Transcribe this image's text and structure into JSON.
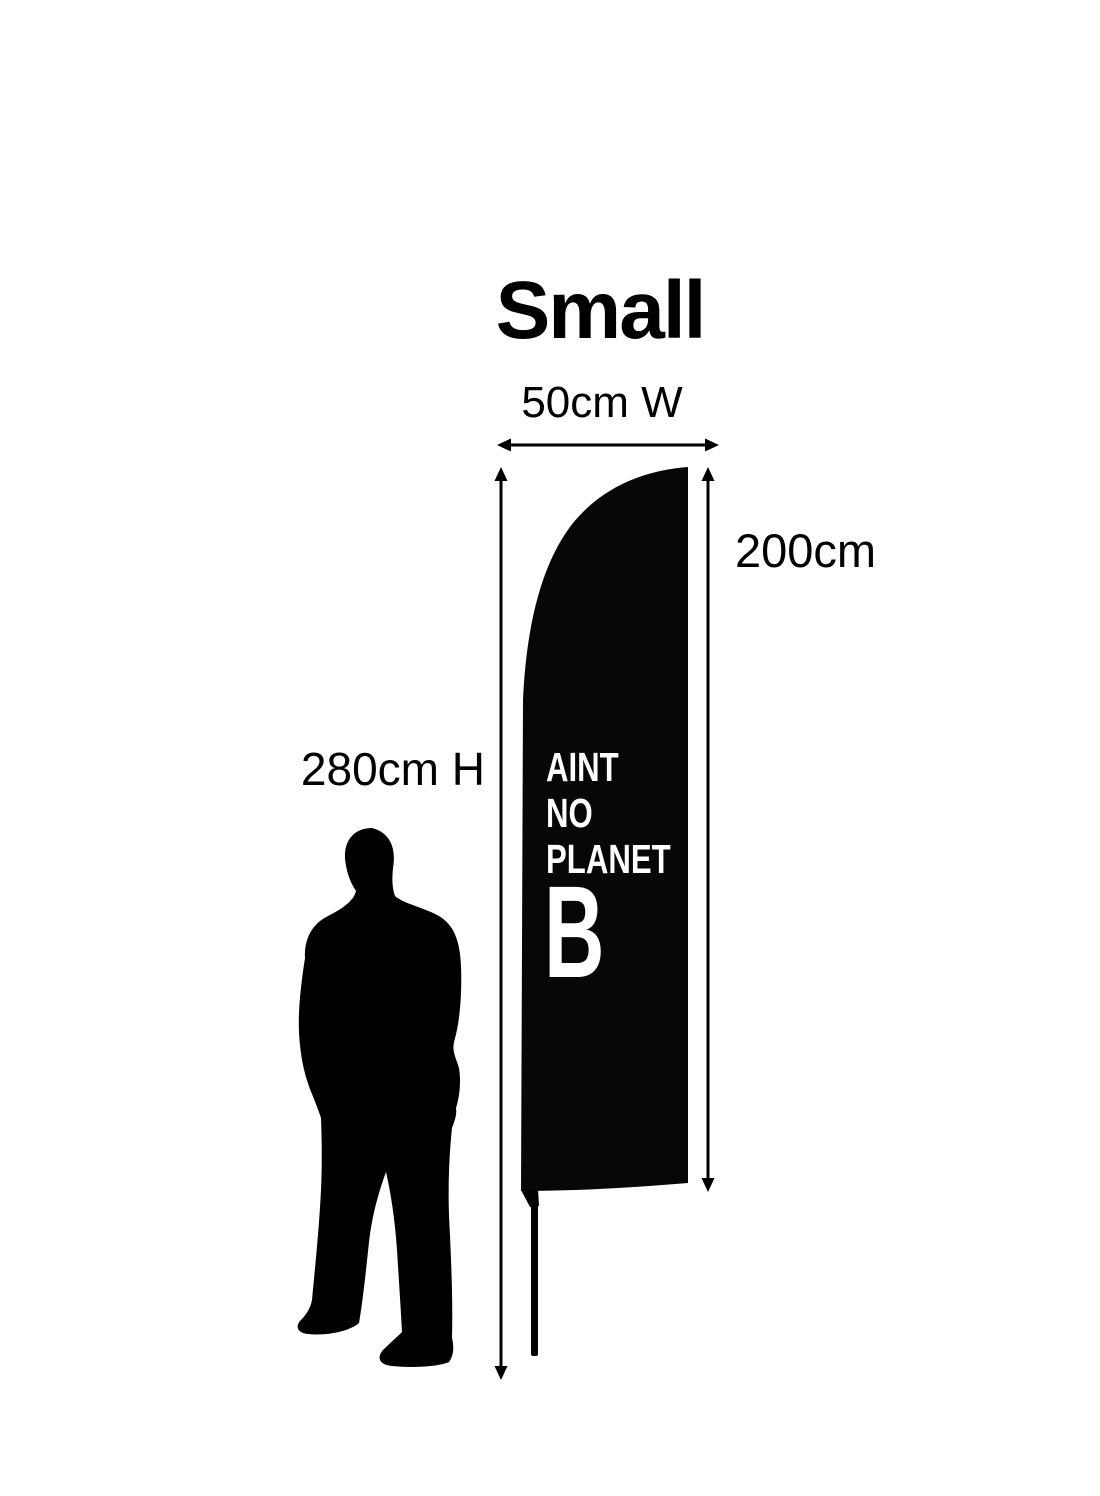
{
  "canvas": {
    "width": 1100,
    "height": 1496,
    "background": "#ffffff",
    "ink": "#000000"
  },
  "title": "Small",
  "labels": {
    "width": "50cm W",
    "flag_height": "200cm",
    "total_height": "280cm H"
  },
  "flag": {
    "color": "#070707",
    "text_color": "#ffffff",
    "slogan_line_1": "AINT",
    "slogan_line_2": "NO",
    "slogan_line_3": "PLANET",
    "slogan_big_letter": "B"
  }
}
